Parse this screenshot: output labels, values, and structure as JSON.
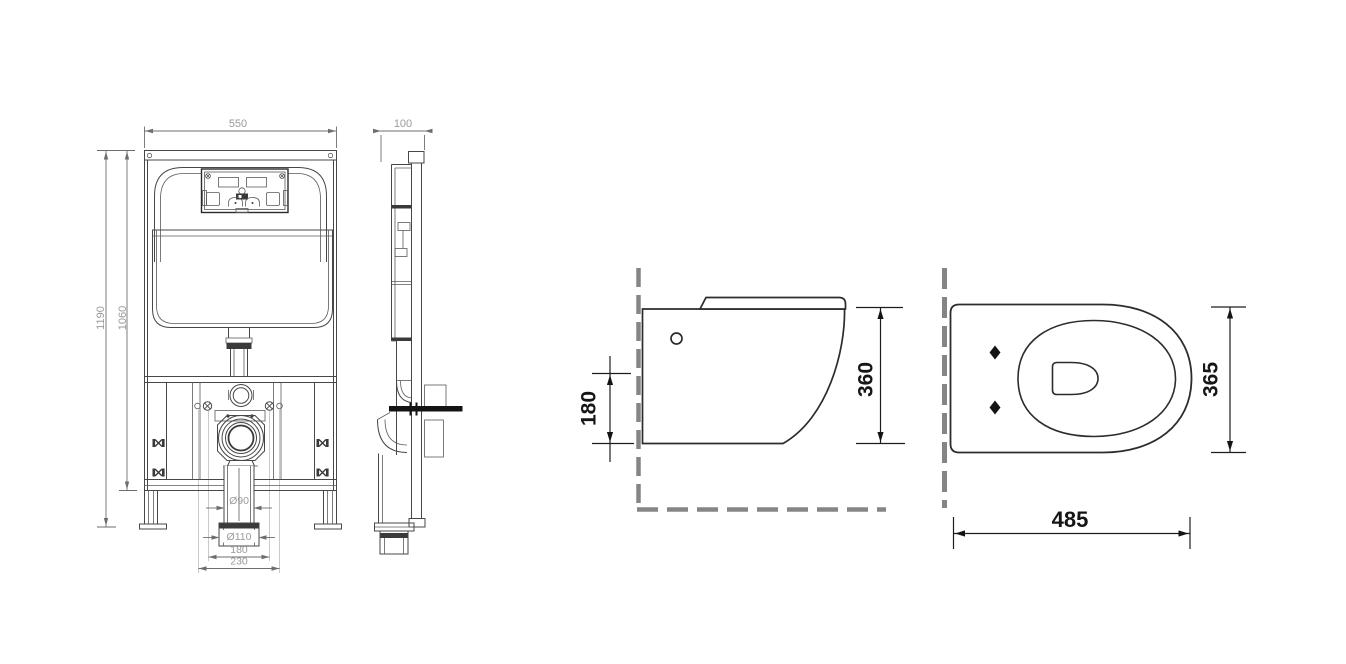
{
  "colors": {
    "background": "#ffffff",
    "frame_line": "#474747",
    "toilet_line": "#2c2c2c",
    "dashed_reference_line": "#858585",
    "dim_text_small": "#9a9a9a",
    "dim_text_large": "#161616"
  },
  "frame_front_view": {
    "dim_width_top": "550",
    "dim_height_total": "1190",
    "dim_height_frame": "1060",
    "dim_outlet_pipe_diameter": "Ø90",
    "dim_outlet_collar_diameter": "Ø110",
    "dim_bolt_spacing_inner": "180",
    "dim_bolt_spacing_outer": "230"
  },
  "frame_side_view": {
    "dim_depth_top": "100"
  },
  "toilet_side_view": {
    "dim_mounting_height": "180",
    "dim_body_height": "360"
  },
  "toilet_top_view": {
    "dim_width": "365",
    "dim_depth": "485"
  }
}
